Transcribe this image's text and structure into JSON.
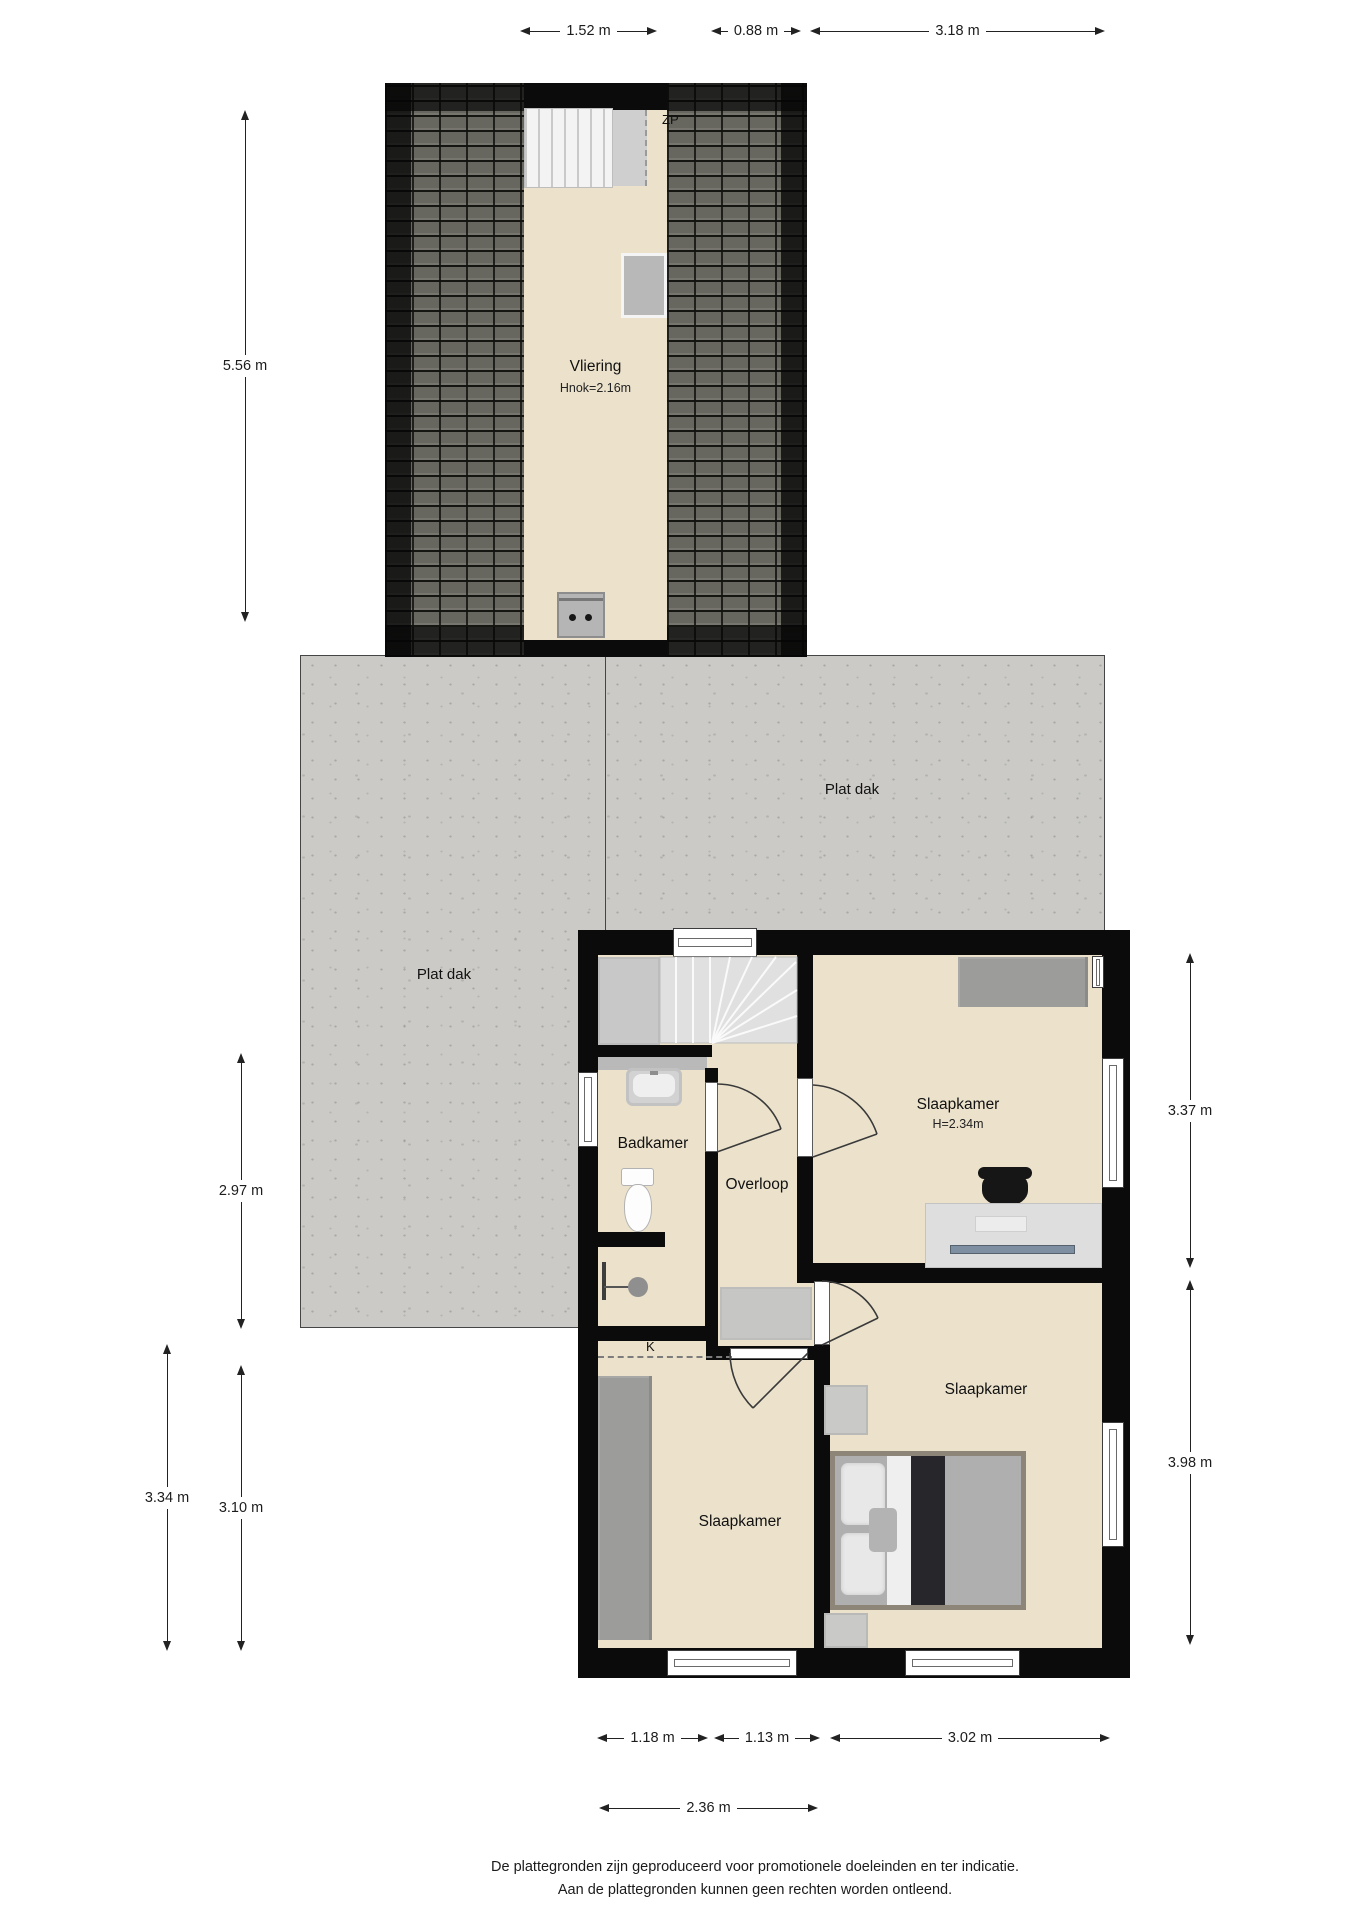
{
  "attic": {
    "zp_label": "ZP",
    "room_label": "Vliering",
    "height_note": "Hnok=2.16m"
  },
  "flat_roof": {
    "label_left": "Plat dak",
    "label_right": "Plat dak"
  },
  "rooms": {
    "bathroom": "Badkamer",
    "landing": "Overloop",
    "bedroom_top_right": "Slaapkamer",
    "bedroom_top_right_height": "H=2.34m",
    "bedroom_bottom_right": "Slaapkamer",
    "bedroom_bottom_left": "Slaapkamer",
    "closet_label": "K"
  },
  "dimensions": {
    "top": [
      "1.52 m",
      "0.88 m",
      "3.18 m"
    ],
    "left": [
      "5.56 m",
      "2.97 m",
      "3.34 m",
      "3.10 m"
    ],
    "right": [
      "3.37 m",
      "3.98 m"
    ],
    "bottom": [
      "1.18 m",
      "1.13 m",
      "3.02 m",
      "2.36 m"
    ]
  },
  "footer": {
    "line1": "De plattegronden zijn geproduceerd voor promotionele doeleinden en ter indicatie.",
    "line2": "Aan de plattegronden kunnen geen rechten worden ontleend."
  },
  "colors": {
    "floor": "#ece2cc",
    "wall": "#0b0b0b",
    "flat_roof": "#cbcac6",
    "roof_tiles": "#67675f",
    "furniture_gray": "#9c9c9a",
    "dim_text": "#222222"
  }
}
